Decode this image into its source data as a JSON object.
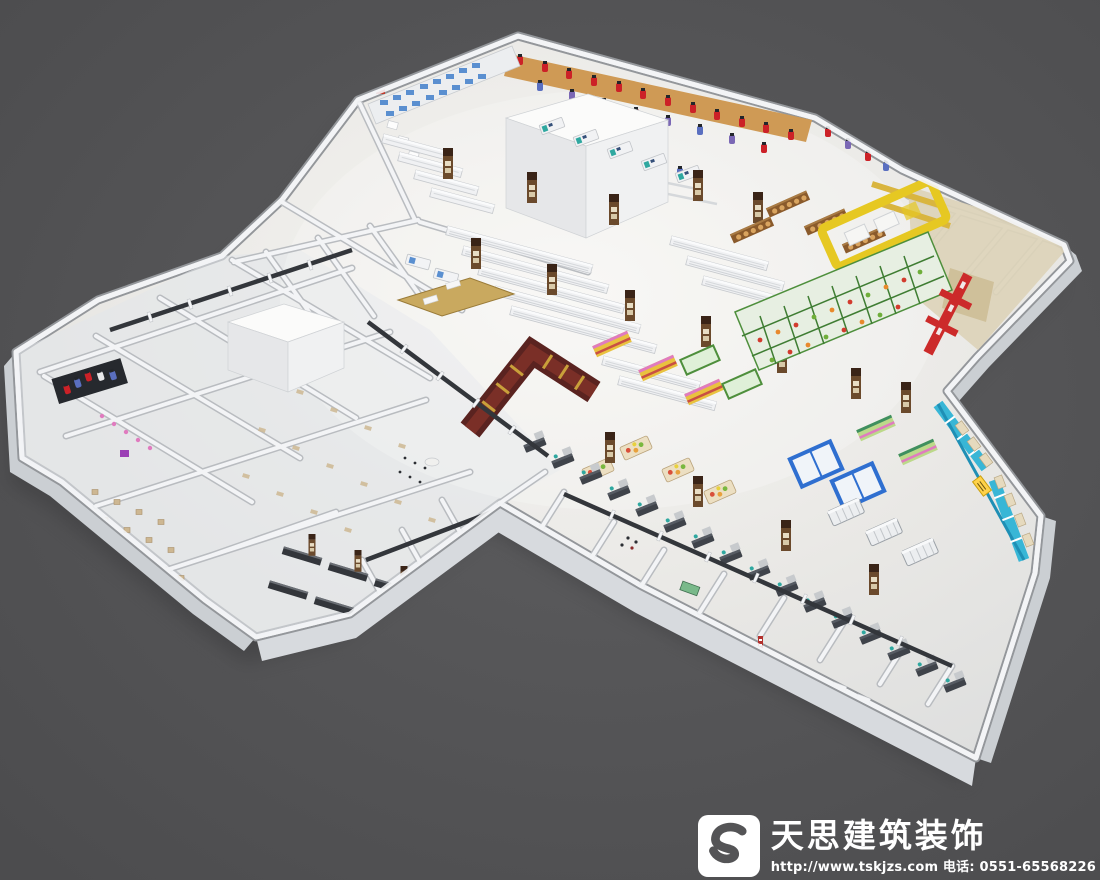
{
  "watermark": {
    "company_name": "天思建筑装饰",
    "url_line": "http://www.tskjzs.com 电话: 0551-65568226",
    "logo_monogram": "S"
  },
  "scene": {
    "subject": "supermarket-interior-3d-floorplan-render"
  },
  "palette": {
    "background": "#4c4c4e",
    "background_light": "#5d5d5f",
    "floor": "#e9e8e5",
    "floor_light": "#f7f6f3",
    "wall": "#f3f4f6",
    "wall_shadow": "#b9bcc0",
    "wall_band": "#cbcfd3",
    "clothing_wall_tan": "#cf9a55",
    "garment_red": "#cc2127",
    "garment_blue": "#5a6fc0",
    "garment_purple": "#7b68b5",
    "garment_white": "#e8e8ea",
    "appliance_blue": "#5a8fd0",
    "pillar_brown": "#6b4a2c",
    "pillar_dark": "#3a2417",
    "produce_green": "#4e8f3c",
    "bakery_brown": "#8a5a2b",
    "bread_tan": "#d9a45f",
    "counter_yellow": "#e6c822",
    "display_red": "#cc2a2a",
    "wine_maroon": "#5a2320",
    "wine_inner": "#7a2f27",
    "gold": "#c9a03a",
    "freezer_cyan": "#38b6d6",
    "freezer_deep": "#1f8fb5",
    "frame_blue": "#2f6fd0",
    "checkout_dark": "#3f434a",
    "checkout_top": "#c7cacd",
    "beige_room": "#ddd3b8",
    "tile_tan": "#cdb792",
    "accent_teal": "#2fa8a0",
    "pink": "#e07bbf",
    "silver": "#eceef0"
  }
}
